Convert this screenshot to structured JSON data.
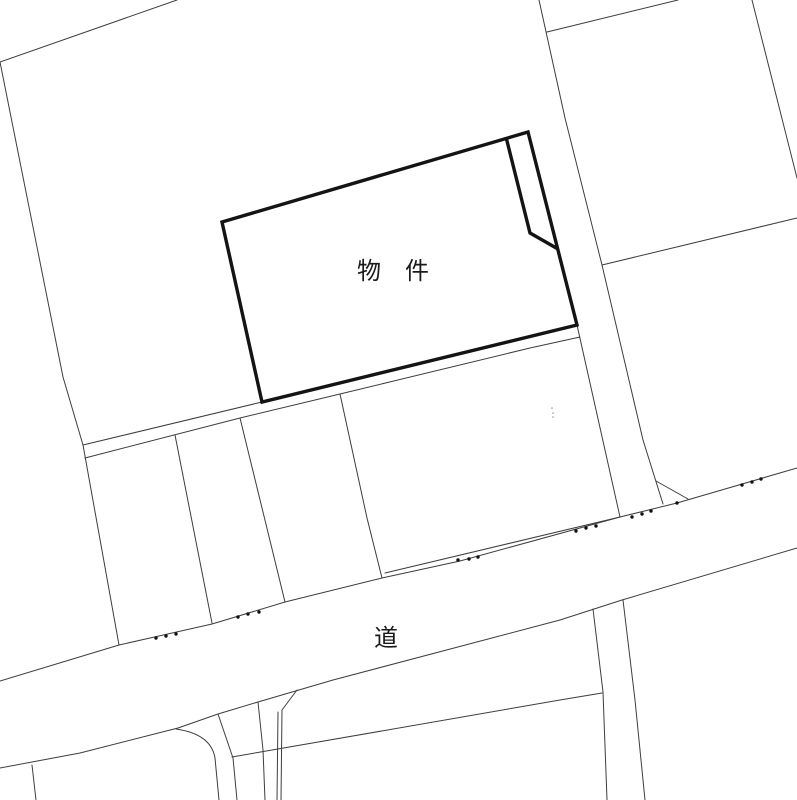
{
  "map": {
    "width": 797,
    "height": 800,
    "background": "#ffffff",
    "colors": {
      "thin_line": "#3d3d3d",
      "bold_line": "#141414",
      "survey_dot": "#111111",
      "faint_dot": "#8f8f8f",
      "label_text": "#1a1a1a"
    },
    "stroke": {
      "thin": 1,
      "bold": 3.4
    },
    "labels": [
      {
        "name": "property-label",
        "text": "物　件",
        "x": 393,
        "y": 279,
        "font_size": 24
      },
      {
        "name": "road-label",
        "text": "道",
        "x": 386,
        "y": 646,
        "font_size": 24
      }
    ],
    "property": {
      "outline": [
        [
          222,
          222
        ],
        [
          528,
          132
        ],
        [
          577,
          325
        ],
        [
          262,
          402
        ]
      ],
      "notch": [
        [
          506,
          137
        ],
        [
          530,
          233
        ],
        [
          558,
          249
        ]
      ]
    },
    "boundary_polylines": [
      {
        "name": "top-left-diagonal-boundary",
        "points": [
          [
            0,
            62
          ],
          [
            177,
            0
          ]
        ]
      },
      {
        "name": "left-parcel-boundary",
        "points": [
          [
            0,
            62
          ],
          [
            63,
            377
          ],
          [
            83,
            445
          ],
          [
            119,
            645
          ]
        ]
      },
      {
        "name": "strip-upper-line",
        "points": [
          [
            83,
            445
          ],
          [
            262,
            402
          ]
        ]
      },
      {
        "name": "strip-lower-line",
        "points": [
          [
            85,
            458
          ],
          [
            240,
            418
          ],
          [
            340,
            394
          ],
          [
            530,
            348
          ],
          [
            580,
            337
          ]
        ]
      },
      {
        "name": "parcel-divider-1",
        "points": [
          [
            175,
            435
          ],
          [
            212,
            623
          ]
        ]
      },
      {
        "name": "parcel-divider-2",
        "points": [
          [
            240,
            418
          ],
          [
            285,
            602
          ]
        ]
      },
      {
        "name": "parcel-divider-3",
        "points": [
          [
            340,
            394
          ],
          [
            367,
            518
          ],
          [
            382,
            578
          ]
        ]
      },
      {
        "name": "divider-under-property-corner",
        "points": [
          [
            577,
            325
          ],
          [
            620,
            517
          ]
        ]
      },
      {
        "name": "converging-line-above-road",
        "points": [
          [
            385,
            573
          ],
          [
            620,
            517
          ]
        ]
      },
      {
        "name": "right-parcel-boundary",
        "points": [
          [
            539,
            0
          ],
          [
            565,
            118
          ],
          [
            602,
            265
          ],
          [
            643,
            440
          ],
          [
            663,
            504
          ]
        ]
      },
      {
        "name": "road-corner-spur",
        "points": [
          [
            656,
            481
          ],
          [
            688,
            499
          ]
        ]
      },
      {
        "name": "top-right-parcel-top-edge",
        "points": [
          [
            547,
            32
          ],
          [
            678,
            0
          ]
        ]
      },
      {
        "name": "top-right-parcel-right-edge",
        "points": [
          [
            752,
            0
          ],
          [
            797,
            178
          ]
        ]
      },
      {
        "name": "right-parcel-cross-diagonal",
        "points": [
          [
            602,
            265
          ],
          [
            797,
            218
          ]
        ]
      },
      {
        "name": "road-upper-edge",
        "points": [
          [
            0,
            681
          ],
          [
            119,
            645
          ],
          [
            212,
            624
          ],
          [
            285,
            602
          ],
          [
            382,
            578
          ],
          [
            460,
            561
          ],
          [
            620,
            517
          ],
          [
            677,
            503
          ],
          [
            797,
            468
          ]
        ]
      },
      {
        "name": "road-lower-edge",
        "points": [
          [
            0,
            768
          ],
          [
            80,
            753
          ],
          [
            178,
            728
          ],
          [
            218,
            714
          ],
          [
            258,
            702
          ],
          [
            333,
            680
          ],
          [
            560,
            620
          ],
          [
            622,
            600
          ],
          [
            797,
            548
          ]
        ]
      },
      {
        "name": "bottom-left-divider",
        "points": [
          [
            32,
            765
          ],
          [
            36,
            800
          ]
        ]
      },
      {
        "name": "lane-right-edge",
        "points": [
          [
            218,
            714
          ],
          [
            233,
            758
          ],
          [
            237,
            800
          ]
        ]
      },
      {
        "name": "lower-band-left-edge",
        "points": [
          [
            258,
            702
          ],
          [
            263,
            750
          ],
          [
            265,
            800
          ]
        ]
      },
      {
        "name": "lower-band-right-edge-a",
        "points": [
          [
            297,
            690
          ],
          [
            282,
            710
          ],
          [
            281,
            800
          ]
        ]
      },
      {
        "name": "lower-band-right-edge-b",
        "points": [
          [
            278,
            712
          ],
          [
            277,
            800
          ]
        ]
      },
      {
        "name": "lower-diagonal-boundary",
        "points": [
          [
            232,
            757
          ],
          [
            560,
            700
          ],
          [
            602,
            693
          ]
        ]
      },
      {
        "name": "lower-right-band-left-edge",
        "points": [
          [
            593,
            609
          ],
          [
            603,
            692
          ],
          [
            607,
            800
          ]
        ]
      },
      {
        "name": "lower-right-band-right-edge",
        "points": [
          [
            623,
            600
          ],
          [
            635,
            700
          ],
          [
            645,
            800
          ]
        ]
      }
    ],
    "curves": [
      {
        "name": "lane-rounded-corner",
        "d": "M 176 729 Q 211 734 215 758 L 219 800"
      }
    ],
    "survey_dots": [
      [
        156,
        638
      ],
      [
        166,
        636
      ],
      [
        176,
        634
      ],
      [
        238,
        617
      ],
      [
        248,
        614
      ],
      [
        259,
        612
      ],
      [
        458,
        560
      ],
      [
        469,
        559
      ],
      [
        478,
        557
      ],
      [
        576,
        531
      ],
      [
        586,
        528
      ],
      [
        596,
        526
      ],
      [
        632,
        517
      ],
      [
        642,
        514
      ],
      [
        651,
        511
      ],
      [
        677,
        503
      ],
      [
        742,
        485
      ],
      [
        752,
        482
      ],
      [
        761,
        479
      ]
    ],
    "survey_dot_radius": 1.7,
    "faint_dots": [
      [
        552,
        408
      ],
      [
        553,
        413
      ],
      [
        553,
        417
      ]
    ],
    "faint_dot_radius": 0.8
  }
}
